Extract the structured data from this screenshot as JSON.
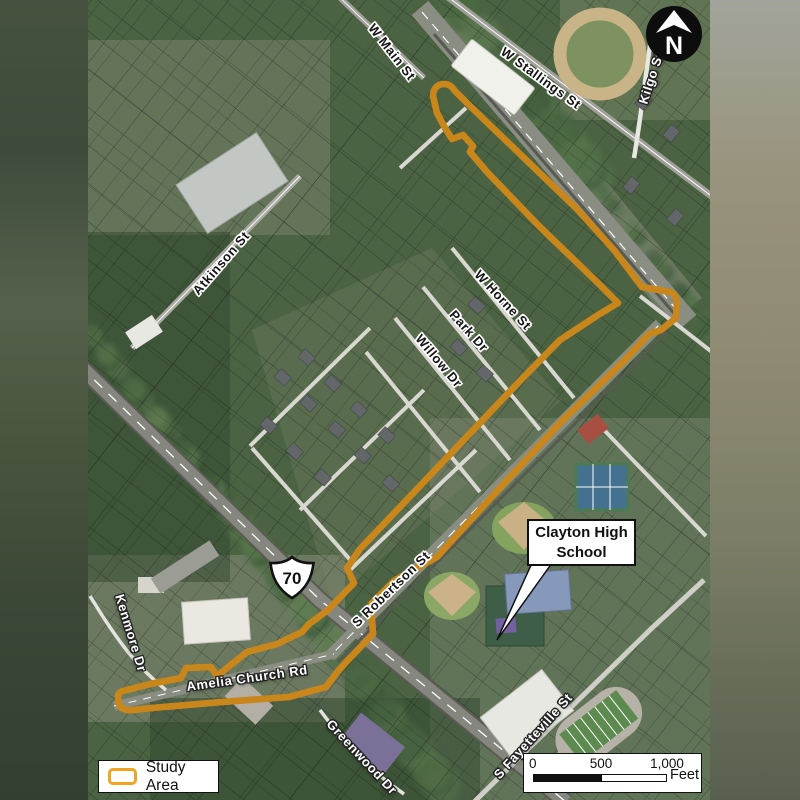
{
  "map": {
    "street_labels": [
      {
        "text": "W Main St",
        "x": 392,
        "y": 52,
        "rotation": 52,
        "style": "dark"
      },
      {
        "text": "W Stallings St",
        "x": 541,
        "y": 78,
        "rotation": 36,
        "style": "dark"
      },
      {
        "text": "Kilgo St",
        "x": 651,
        "y": 78,
        "rotation": -72,
        "style": "light"
      },
      {
        "text": "Atkinson St",
        "x": 221,
        "y": 263,
        "rotation": -49,
        "style": "dark"
      },
      {
        "text": "W Horne St",
        "x": 503,
        "y": 300,
        "rotation": 47,
        "style": "dark"
      },
      {
        "text": "Park Dr",
        "x": 469,
        "y": 331,
        "rotation": 48,
        "style": "dark"
      },
      {
        "text": "Willow Dr",
        "x": 439,
        "y": 361,
        "rotation": 50,
        "style": "dark"
      },
      {
        "text": "S Robertson St",
        "x": 391,
        "y": 589,
        "rotation": -44,
        "style": "dark"
      },
      {
        "text": "Kenmore Dr",
        "x": 131,
        "y": 633,
        "rotation": 73,
        "style": "light"
      },
      {
        "text": "Amelia Church Rd",
        "x": 247,
        "y": 678,
        "rotation": -8,
        "style": "light"
      },
      {
        "text": "Greenwood Dr",
        "x": 362,
        "y": 757,
        "rotation": 47,
        "style": "light"
      },
      {
        "text": "S Fayetteville St",
        "x": 533,
        "y": 736,
        "rotation": -48,
        "style": "light"
      }
    ],
    "highway_shield": {
      "number": "70"
    },
    "callout": {
      "lines": [
        "Clayton High",
        "School"
      ]
    },
    "north_arrow": {
      "letter": "N"
    },
    "legend": {
      "label": "Study Area",
      "swatch_color": "#F2A41F"
    },
    "scale_bar": {
      "tick_start": "0",
      "tick_mid": "500",
      "tick_end": "1,000",
      "unit": "Feet"
    }
  }
}
